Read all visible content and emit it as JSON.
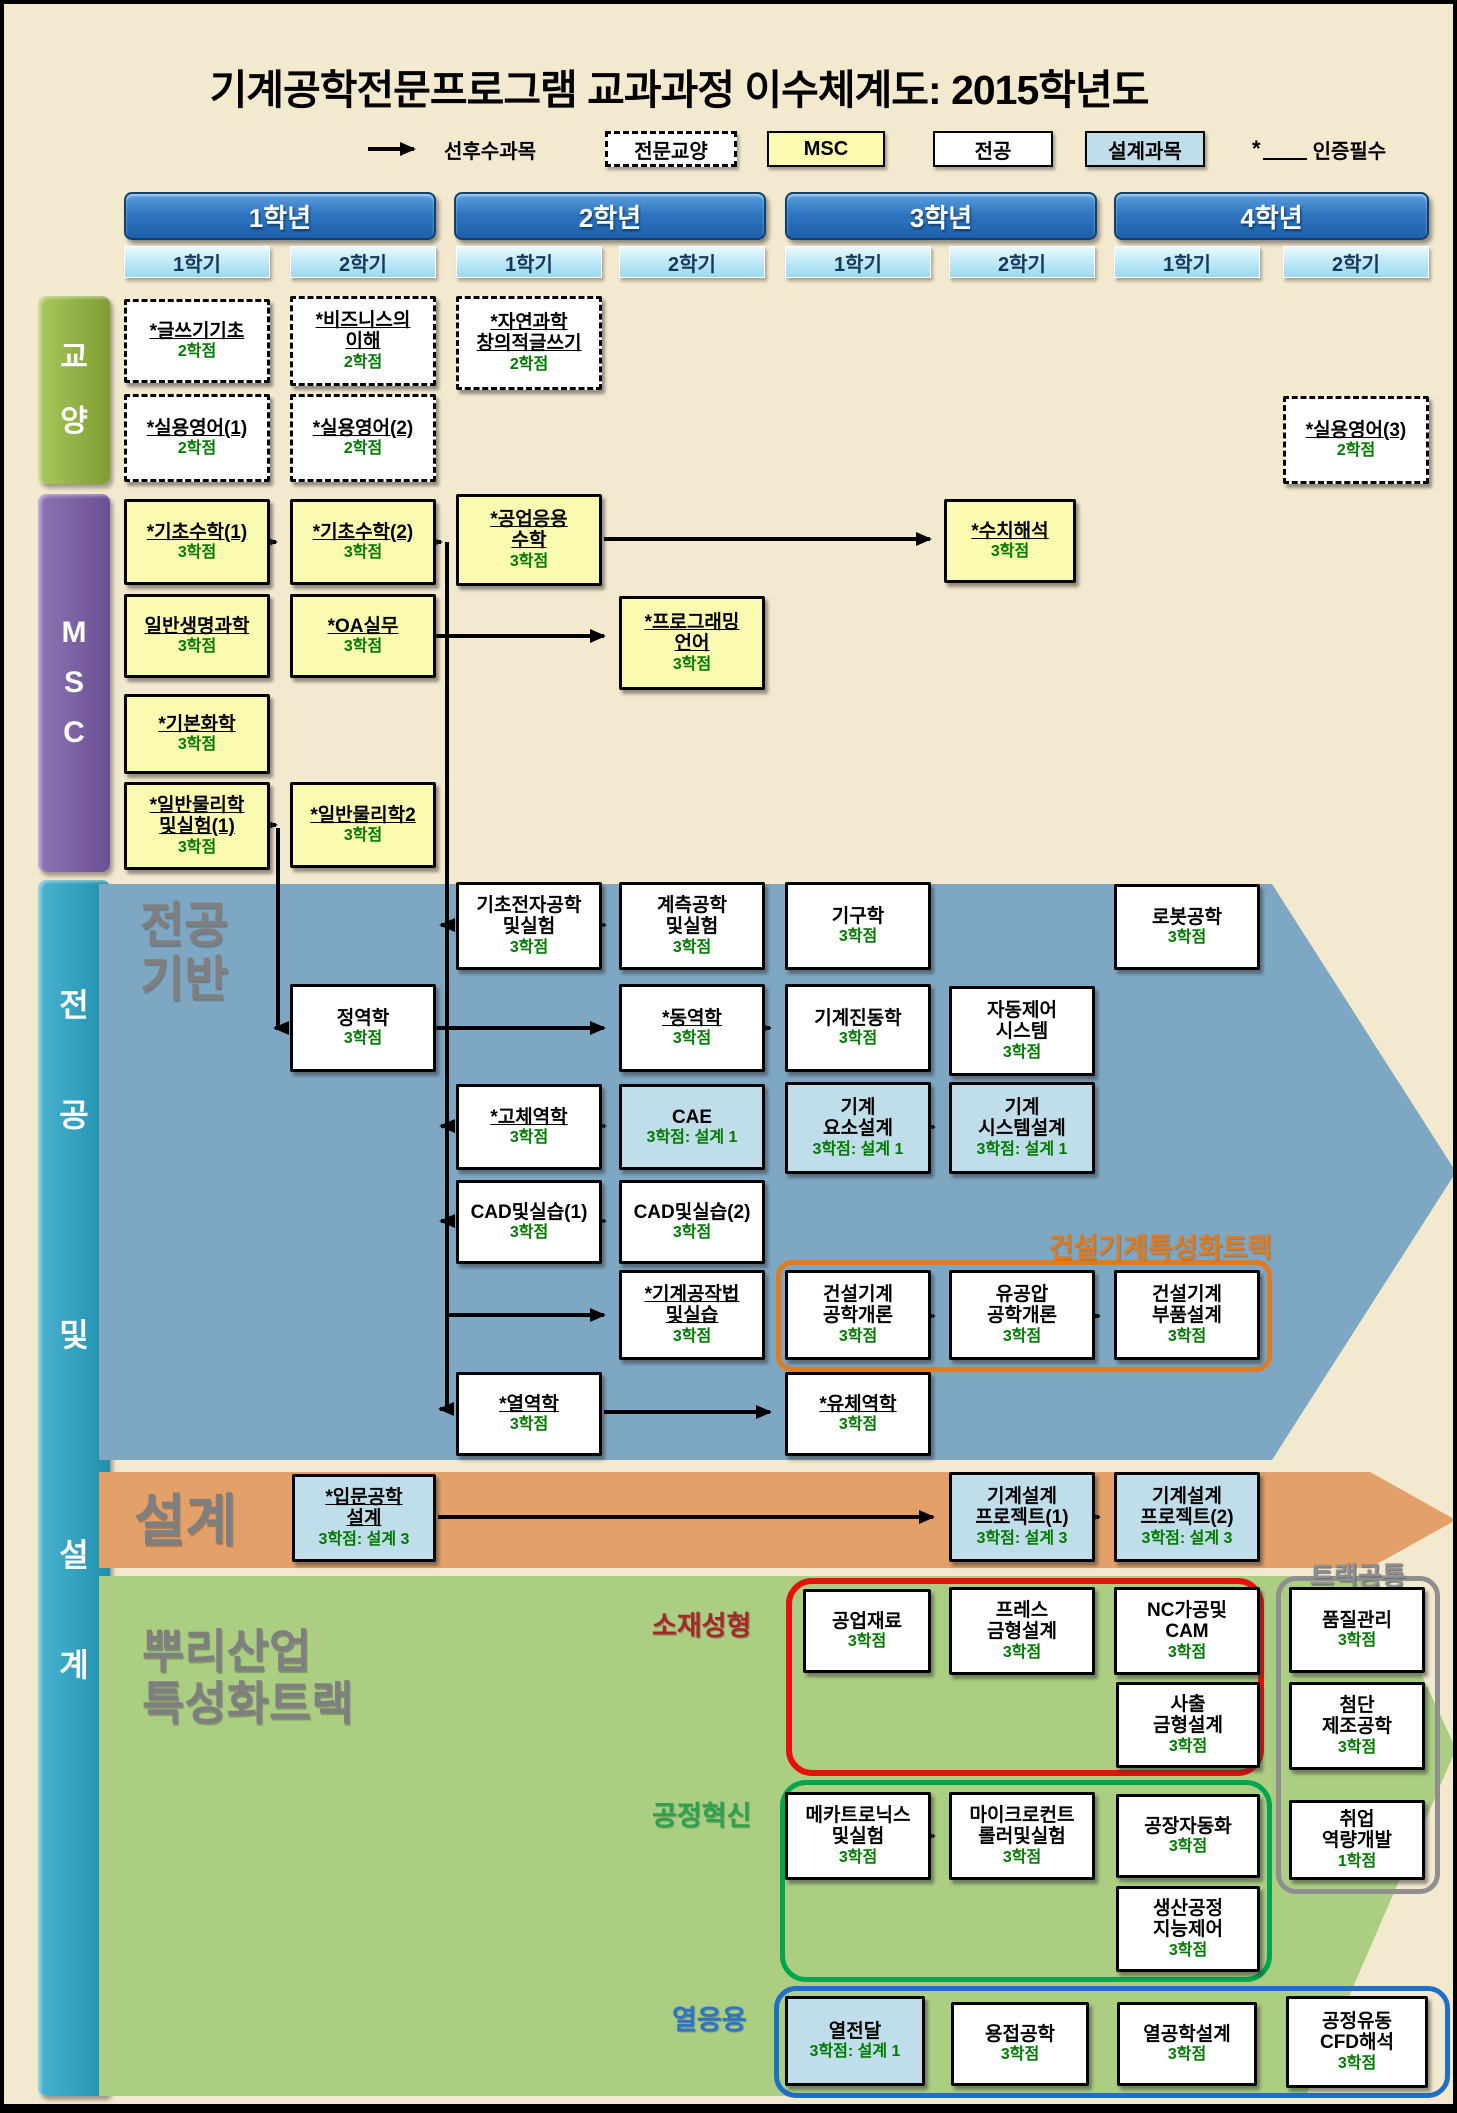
{
  "title": "기계공학전문프로그램 교과과정 이수체계도: 2015학년도",
  "legend": {
    "arrow_label": "선후수과목",
    "general_edu": "전문교양",
    "msc": "MSC",
    "major": "전공",
    "design": "설계과목",
    "required_star": "*",
    "required_label": "인증필수"
  },
  "years": [
    {
      "label": "1학년",
      "sem1": "1학기",
      "sem2": "2학기"
    },
    {
      "label": "2학년",
      "sem1": "1학기",
      "sem2": "2학기"
    },
    {
      "label": "3학년",
      "sem1": "1학기",
      "sem2": "2학기"
    },
    {
      "label": "4학년",
      "sem1": "1학기",
      "sem2": "2학기"
    }
  ],
  "sidebars": {
    "ge": "교\n양",
    "msc": "M\nS\nC",
    "major": "전\n공\n\n및\n\n설\n계"
  },
  "regions": {
    "major_base": "전공\n기반",
    "design": "설계",
    "root_track": "뿌리산업\n특성화트랙"
  },
  "tracks": {
    "construction": "건설기계특성화트랙",
    "common": "트랙공통",
    "material": "소재성형",
    "process": "공정혁신",
    "thermal": "열응용"
  },
  "colors": {
    "background": "#F3E9CF",
    "msc_box": "#FAFAB0",
    "design_box": "#BFDEE9",
    "region_major": "#7EA7C3",
    "region_design": "#E3A169",
    "region_root": "#ABCE82",
    "credit_green": "#007A00",
    "track_construction": "#E07B20",
    "track_material": "#E8100C",
    "track_process": "#00A64F",
    "track_thermal": "#1E6FC8",
    "track_common": "#8F8F8F",
    "year_header": "#2F76C0",
    "semester_header": "#AEE3F4"
  },
  "courses": {
    "writing-basics": {
      "name": "*글쓰기기초",
      "credit": "2학점"
    },
    "business-understanding": {
      "name": "*비즈니스의\n이해",
      "credit": "2학점"
    },
    "science-creative-writing": {
      "name": "*자연과학\n창의적글쓰기",
      "credit": "2학점"
    },
    "practical-english-1": {
      "name": "*실용영어(1)",
      "credit": "2학점"
    },
    "practical-english-2": {
      "name": "*실용영어(2)",
      "credit": "2학점"
    },
    "practical-english-3": {
      "name": "*실용영어(3)",
      "credit": "2학점"
    },
    "basic-math-1": {
      "name": "*기초수학(1)",
      "credit": "3학점"
    },
    "basic-math-2": {
      "name": "*기초수학(2)",
      "credit": "3학점"
    },
    "engineering-applied-math": {
      "name": "*공업응용\n수학",
      "credit": "3학점"
    },
    "numerical-analysis": {
      "name": "*수치해석",
      "credit": "3학점"
    },
    "general-life-science": {
      "name": "일반생명과학",
      "credit": "3학점"
    },
    "oa-practice": {
      "name": "*OA실무",
      "credit": "3학점"
    },
    "programming-language": {
      "name": "*프로그래밍\n언어",
      "credit": "3학점"
    },
    "basic-chemistry": {
      "name": "*기본화학",
      "credit": "3학점"
    },
    "general-physics-lab-1": {
      "name": "*일반물리학\n및실험(1)",
      "credit": "3학점"
    },
    "general-physics-2": {
      "name": "*일반물리학2",
      "credit": "3학점"
    },
    "basic-electronics-lab": {
      "name": "기초전자공학\n및실험",
      "credit": "3학점"
    },
    "instrumentation-lab": {
      "name": "계측공학\n및실험",
      "credit": "3학점"
    },
    "mechanisms": {
      "name": "기구학",
      "credit": "3학점"
    },
    "robotics": {
      "name": "로봇공학",
      "credit": "3학점"
    },
    "statics": {
      "name": "정역학",
      "credit": "3학점"
    },
    "dynamics": {
      "name": "*동역학",
      "credit": "3학점"
    },
    "mechanical-vibrations": {
      "name": "기계진동학",
      "credit": "3학점"
    },
    "automatic-control-systems": {
      "name": "자동제어\n시스템",
      "credit": "3학점"
    },
    "solid-mechanics": {
      "name": "*고체역학",
      "credit": "3학점"
    },
    "cae": {
      "name": "CAE",
      "credit": "3학점: 설계 1"
    },
    "machine-element-design": {
      "name": "기계\n요소설계",
      "credit": "3학점: 설계 1"
    },
    "machine-system-design": {
      "name": "기계\n시스템설계",
      "credit": "3학점: 설계 1"
    },
    "cad-practice-1": {
      "name": "CAD및실습(1)",
      "credit": "3학점"
    },
    "cad-practice-2": {
      "name": "CAD및실습(2)",
      "credit": "3학점"
    },
    "machining-practice": {
      "name": "*기계공작법\n및실습",
      "credit": "3학점"
    },
    "construction-machinery-intro": {
      "name": "건설기계\n공학개론",
      "credit": "3학점"
    },
    "hydraulic-pneumatic-intro": {
      "name": "유공압\n공학개론",
      "credit": "3학점"
    },
    "construction-machinery-parts": {
      "name": "건설기계\n부품설계",
      "credit": "3학점"
    },
    "thermodynamics": {
      "name": "*열역학",
      "credit": "3학점"
    },
    "fluid-mechanics": {
      "name": "*유체역학",
      "credit": "3학점"
    },
    "intro-engineering-design": {
      "name": "*입문공학\n설계",
      "credit": "3학점: 설계 3"
    },
    "machine-design-project-1": {
      "name": "기계설계\n프로젝트(1)",
      "credit": "3학점: 설계 3"
    },
    "machine-design-project-2": {
      "name": "기계설계\n프로젝트(2)",
      "credit": "3학점: 설계 3"
    },
    "engineering-materials": {
      "name": "공업재료",
      "credit": "3학점"
    },
    "press-die-design": {
      "name": "프레스\n금형설계",
      "credit": "3학점"
    },
    "nc-machining-cam": {
      "name": "NC가공및\nCAM",
      "credit": "3학점"
    },
    "injection-mold-design": {
      "name": "사출\n금형설계",
      "credit": "3학점"
    },
    "mechatronics-lab": {
      "name": "메카트로닉스\n및실험",
      "credit": "3학점"
    },
    "microcontroller-lab": {
      "name": "마이크로컨트\n롤러및실험",
      "credit": "3학점"
    },
    "factory-automation": {
      "name": "공장자동화",
      "credit": "3학점"
    },
    "production-intelligent-control": {
      "name": "생산공정\n지능제어",
      "credit": "3학점"
    },
    "heat-transfer": {
      "name": "열전달",
      "credit": "3학점: 설계 1"
    },
    "welding-engineering": {
      "name": "용접공학",
      "credit": "3학점"
    },
    "thermal-engineering-design": {
      "name": "열공학설계",
      "credit": "3학점"
    },
    "process-flow-cfd": {
      "name": "공정유동\nCFD해석",
      "credit": "3학점"
    },
    "quality-control": {
      "name": "품질관리",
      "credit": "3학점"
    },
    "advanced-manufacturing": {
      "name": "첨단\n제조공학",
      "credit": "3학점"
    },
    "career-development": {
      "name": "취업\n역량개발",
      "credit": "1학점"
    }
  }
}
